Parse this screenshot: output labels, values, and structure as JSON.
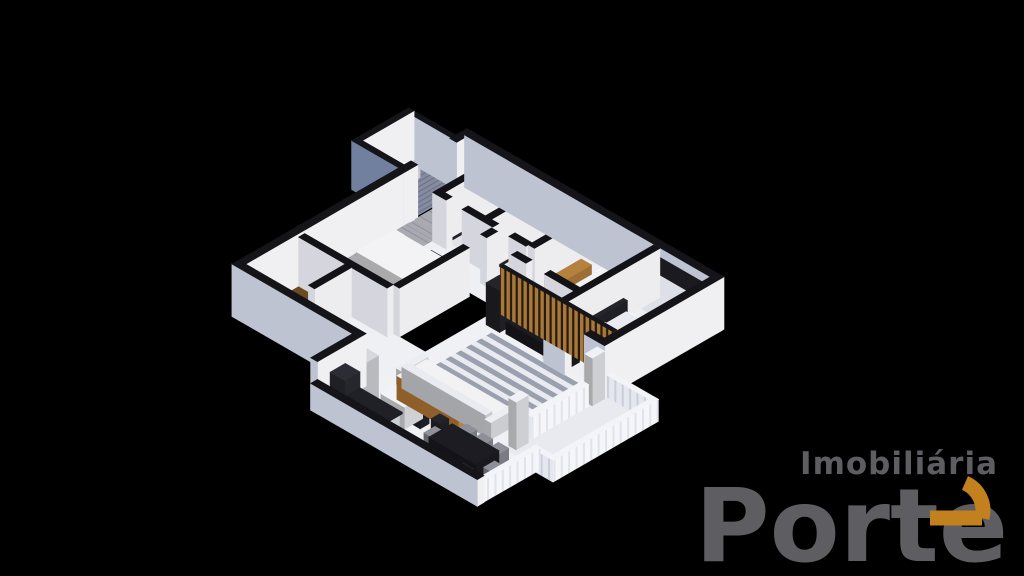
{
  "background_color": "#000000",
  "logo": {
    "top_text": "Imobiliária",
    "main_text": "Porte",
    "gray": "#5e5d61",
    "orange": "#c2801f"
  },
  "scene": {
    "projection": {
      "cos": 0.866,
      "sin": 0.5,
      "kz": 0.82,
      "fit": [
        232,
        88,
        492,
        438
      ]
    },
    "palettes": {
      "E": {
        "t": "#141419",
        "px": "#f0f0f3",
        "py": "#bdc3d1"
      },
      "I": {
        "t": "#121217",
        "px": "#ededf0",
        "py": "#d5d6dd"
      },
      "R": {
        "t": "#f3f4f7",
        "px": "pat:balX",
        "py": "pat:balY"
      },
      "G": {
        "t": "#141419",
        "px": "#eef0f3",
        "py": "#71809f"
      },
      "S": {
        "t": "#15151a",
        "px": "#7a5526",
        "py": "pat:slatY"
      },
      "W": {
        "t": "#1a1a1f",
        "px": "#f0f1f4",
        "py": "#dde0e7"
      },
      "B": {
        "t": "#f2f3f5",
        "px": "#b5813f",
        "py": "#8f5f2a"
      }
    },
    "pattern_colors": {
      "plank_bg": "#a9a9b2",
      "plank_line": "#94949e",
      "plank_joint": "#9c9ca6",
      "grate_bg": "#868ca0",
      "grate_line": "#6f7488",
      "slat_bg": "#241c12",
      "slat_bar": "#a97737",
      "balY_bg": "#e4e7ed",
      "balY_line": "#c9cedb",
      "balX_bg": "#f5f6f9",
      "balX_line": "#e0e3ea"
    },
    "floors": [
      {
        "name": "service-floor",
        "r": [
          -2.1,
          0.25,
          2.05,
          1.9
        ],
        "f": "pat:grate"
      },
      {
        "name": "entry-corridor-floor",
        "r": [
          0,
          -0.05,
          1.15,
          2.55
        ],
        "f": "pat:plank"
      },
      {
        "name": "bedroom1-floor",
        "r": [
          0,
          2.5,
          3.6,
          4.1
        ],
        "f": "pat:plank"
      },
      {
        "name": "bath1-floor",
        "r": [
          1.4,
          0,
          1.65,
          2.3
        ],
        "f": "#e2e3e9"
      },
      {
        "name": "bath2-floor",
        "r": [
          3.3,
          0,
          1.65,
          2.3
        ],
        "f": "#e2e3e9"
      },
      {
        "name": "bedroom2-floor",
        "r": [
          5.2,
          0,
          2.3,
          2.9
        ],
        "f": "#edeff3"
      },
      {
        "name": "hall-floor",
        "r": [
          1.15,
          2.3,
          3.75,
          1.3
        ],
        "f": "#eef0f4"
      },
      {
        "name": "living-floor",
        "r": [
          4.9,
          2.9,
          5.0,
          5.5
        ],
        "f": "#f0f1f5"
      },
      {
        "name": "bedroom3-floor",
        "r": [
          7.7,
          0,
          2.2,
          4.3
        ],
        "f": "#edeff3"
      },
      {
        "name": "kitchen-floor",
        "r": [
          0,
          6.6,
          4.9,
          2.4
        ],
        "f": "#eef0f4"
      },
      {
        "name": "dining-floor",
        "r": [
          4.9,
          8.4,
          6.3,
          2.3
        ],
        "f": "#f0f1f5"
      },
      {
        "name": "balcony-floor",
        "r": [
          9.9,
          4.3,
          2.0,
          4.1
        ],
        "f": "#e8eaef"
      }
    ],
    "rug": {
      "name": "living-striped-rug",
      "r": [
        5.6,
        4.6,
        3.9,
        2.7
      ],
      "stripes": 13,
      "colors": [
        "#9aa0ae",
        "#e9ebf1"
      ]
    },
    "walls": [
      [
        -0.1,
        -0.28,
        10.28,
        0.28,
        2.25,
        "E"
      ],
      [
        9.9,
        -0.2,
        0.28,
        4.78,
        2.25,
        "E"
      ],
      [
        -0.28,
        -0.28,
        0.28,
        0.7,
        2.25,
        "E"
      ],
      [
        -0.28,
        2.0,
        0.28,
        0.6,
        2.25,
        "E"
      ],
      [
        -0.28,
        2.6,
        0.28,
        4.0,
        2.25,
        "E"
      ],
      [
        -0.28,
        6.6,
        0.28,
        2.68,
        2.25,
        "E"
      ],
      [
        -0.28,
        9.0,
        5.18,
        0.28,
        2.25,
        "E"
      ],
      [
        4.62,
        9.0,
        0.28,
        1.98,
        2.25,
        "E"
      ],
      [
        4.62,
        10.7,
        6.78,
        0.28,
        1.15,
        "E"
      ],
      [
        7.7,
        4.3,
        0.85,
        0.28,
        2.25,
        "E"
      ],
      [
        9.35,
        4.3,
        0.83,
        0.28,
        2.25,
        "E"
      ],
      [
        -2.3,
        0.05,
        2.3,
        0.2,
        2.1,
        "E"
      ],
      [
        -2.32,
        0.05,
        0.22,
        2.32,
        2.1,
        "E"
      ],
      [
        -2.32,
        2.15,
        2.34,
        0.22,
        2.1,
        "G"
      ],
      [
        10.18,
        4.3,
        1.92,
        0.2,
        0.95,
        "R"
      ],
      [
        11.9,
        4.3,
        0.2,
        4.3,
        0.95,
        "R"
      ],
      [
        11.2,
        8.4,
        0.72,
        0.2,
        0.95,
        "R"
      ],
      [
        11.2,
        8.4,
        0.2,
        2.58,
        0.95,
        "R"
      ],
      [
        9.9,
        5.2,
        0.26,
        2.3,
        0.95,
        "R"
      ],
      [
        1.15,
        -0.1,
        0.25,
        2.55,
        2.1,
        "I"
      ],
      [
        3.05,
        -0.1,
        0.25,
        2.55,
        2.1,
        "I"
      ],
      [
        4.95,
        -0.1,
        0.25,
        2.55,
        2.1,
        "I"
      ],
      [
        7.5,
        -0.1,
        0.25,
        3.0,
        2.1,
        "I"
      ],
      [
        1.15,
        2.3,
        0.55,
        0.25,
        2.1,
        "I"
      ],
      [
        2.35,
        2.3,
        1.25,
        0.25,
        2.1,
        "I"
      ],
      [
        4.25,
        2.3,
        0.7,
        0.25,
        2.1,
        "I"
      ],
      [
        4.95,
        2.9,
        0.6,
        0.25,
        2.1,
        "I"
      ],
      [
        6.3,
        2.9,
        1.2,
        0.25,
        2.1,
        "I"
      ],
      [
        7.5,
        2.9,
        0.25,
        1.55,
        2.1,
        "I"
      ],
      [
        3.6,
        2.6,
        0.25,
        0.45,
        2.1,
        "I"
      ],
      [
        3.6,
        3.75,
        0.25,
        2.85,
        2.1,
        "I"
      ],
      [
        0,
        6.6,
        3.6,
        0.25,
        2.1,
        "I"
      ],
      [
        1.9,
        6.85,
        0.25,
        1.5,
        2.1,
        "I"
      ],
      [
        5.1,
        3.6,
        4.6,
        0.15,
        2.05,
        "S"
      ]
    ],
    "furniture": [
      [
        -1.95,
        0.55,
        0.6,
        0.65,
        0.92,
        "#e9e9ee"
      ],
      [
        0.35,
        3.3,
        2.1,
        1.55,
        0.46,
        "#f3f3f6"
      ],
      [
        0.45,
        3.42,
        0.4,
        0.62,
        0.63,
        "#ffffff"
      ],
      [
        0.45,
        4.2,
        0.4,
        0.62,
        0.63,
        "#ffffff"
      ],
      [
        1.85,
        3.3,
        0.55,
        1.55,
        0.5,
        "#2c3754"
      ],
      [
        1.6,
        0.4,
        0.45,
        0.6,
        0.52,
        "#fafafc"
      ],
      [
        2.4,
        0.35,
        0.5,
        0.5,
        0.85,
        "#eef0f3"
      ],
      [
        3.5,
        0.4,
        0.45,
        0.6,
        0.52,
        "#fafafc"
      ],
      [
        4.3,
        0.35,
        0.5,
        0.5,
        0.85,
        "#eef0f3"
      ],
      [
        5.95,
        0.3,
        1.45,
        2.0,
        0.46,
        "#f2f2f5"
      ],
      [
        6.05,
        0.4,
        1.25,
        0.42,
        0.62,
        "#ffffff"
      ],
      [
        5.25,
        0.6,
        0.42,
        1.5,
        0.55,
        "#b5813f"
      ],
      [
        5.22,
        0.85,
        0.07,
        1.0,
        0.55,
        "#14141a",
        1.05
      ],
      [
        7.8,
        0.05,
        2.0,
        0.62,
        1.9,
        "W"
      ],
      [
        7.82,
        1.45,
        0.16,
        1.9,
        0.95,
        "#24242b"
      ],
      [
        7.98,
        1.5,
        1.8,
        1.8,
        0.5,
        "#eaebf0"
      ],
      [
        8.06,
        1.6,
        0.45,
        0.7,
        0.68,
        "#f6f7f9"
      ],
      [
        8.06,
        2.45,
        0.45,
        0.7,
        0.68,
        "#f6f7f9"
      ],
      [
        7.82,
        3.5,
        0.4,
        0.4,
        0.5,
        "#1e1e24"
      ],
      [
        5.18,
        3.85,
        0.55,
        0.55,
        1.8,
        "#24242a"
      ],
      [
        5.9,
        3.82,
        2.5,
        0.5,
        0.52,
        "#1b1b21"
      ],
      [
        6.2,
        3.79,
        1.8,
        0.07,
        0.95,
        "#101015",
        0.75
      ],
      [
        5.7,
        7.35,
        3.4,
        1.0,
        0.62,
        "#f2f2f5"
      ],
      [
        5.7,
        8.08,
        3.4,
        0.27,
        0.92,
        "#eaebf0"
      ],
      [
        5.48,
        7.3,
        0.24,
        1.05,
        0.72,
        "#eceef2"
      ],
      [
        9.08,
        7.3,
        0.24,
        1.05,
        0.72,
        "#eceef2"
      ],
      [
        4.95,
        9.15,
        0.6,
        0.65,
        1.8,
        "#d6d8dd"
      ],
      [
        4.95,
        9.9,
        0.6,
        0.62,
        1.55,
        "#2c2c34"
      ],
      [
        5.7,
        10.05,
        1.6,
        0.6,
        0.92,
        "#f0f1f4"
      ],
      [
        5.65,
        10.0,
        1.72,
        0.68,
        0.07,
        "#202027",
        0.92
      ],
      [
        6.25,
        9.0,
        0.95,
        0.75,
        0.95,
        "#f2f3f6"
      ],
      [
        6.5,
        9.2,
        0.2,
        0.2,
        0.28,
        "#b43a20",
        0.95
      ],
      [
        6.0,
        8.45,
        2.5,
        0.4,
        1.02,
        "B"
      ],
      [
        6.35,
        9.05,
        0.36,
        0.36,
        0.7,
        "#23232b"
      ],
      [
        7.15,
        9.05,
        0.36,
        0.36,
        0.7,
        "#23232b"
      ],
      [
        7.95,
        9.05,
        0.36,
        0.36,
        0.7,
        "#23232b"
      ],
      [
        8.6,
        9.2,
        1.9,
        0.95,
        0.76,
        "#1c1c22"
      ],
      [
        8.7,
        8.72,
        0.42,
        0.4,
        0.52,
        "#8e9099"
      ],
      [
        9.35,
        8.72,
        0.42,
        0.4,
        0.52,
        "#8e9099"
      ],
      [
        10.0,
        8.72,
        0.42,
        0.4,
        0.52,
        "#8e9099"
      ],
      [
        8.7,
        10.18,
        0.42,
        0.4,
        0.52,
        "#8e9099"
      ],
      [
        9.35,
        10.18,
        0.42,
        0.4,
        0.52,
        "#8e9099"
      ],
      [
        10.0,
        10.18,
        0.42,
        0.4,
        0.52,
        "#8e9099"
      ],
      [
        8.15,
        9.45,
        0.38,
        0.45,
        0.52,
        "#8e9099"
      ],
      [
        10.58,
        9.45,
        0.38,
        0.45,
        0.52,
        "#8e9099"
      ],
      [
        0.25,
        6.95,
        1.5,
        0.55,
        0.78,
        "#9a6b34"
      ],
      [
        0.55,
        6.9,
        0.6,
        0.07,
        0.55,
        "#2e2e36",
        1.15
      ],
      [
        9.9,
        4.6,
        0.3,
        0.5,
        2.05,
        "#f0f1f4"
      ],
      [
        9.9,
        7.7,
        0.3,
        0.5,
        2.05,
        "#f0f1f4"
      ],
      [
        0.35,
        0.02,
        2.2,
        0.06,
        0.8,
        "#161620",
        0.95
      ],
      [
        5.6,
        0.02,
        1.5,
        0.06,
        0.8,
        "#161620",
        0.95
      ],
      [
        8.0,
        0.02,
        1.6,
        0.06,
        0.8,
        "#161620",
        0.95
      ],
      [
        1.35,
        0.04,
        1.6,
        0.07,
        1.95,
        "#282830"
      ],
      [
        3.25,
        0.04,
        1.6,
        0.07,
        1.95,
        "#282830"
      ],
      [
        1.44,
        0.12,
        0.07,
        2.1,
        1.95,
        "#282830"
      ],
      [
        3.34,
        0.12,
        0.07,
        2.1,
        1.95,
        "#282830"
      ],
      [
        1.2,
        9.3,
        2.2,
        0.06,
        1.6,
        "#6b7794",
        0.35
      ],
      [
        5.6,
        11.0,
        3.2,
        0.06,
        0.5,
        "#1a1a22",
        0.5
      ]
    ]
  }
}
